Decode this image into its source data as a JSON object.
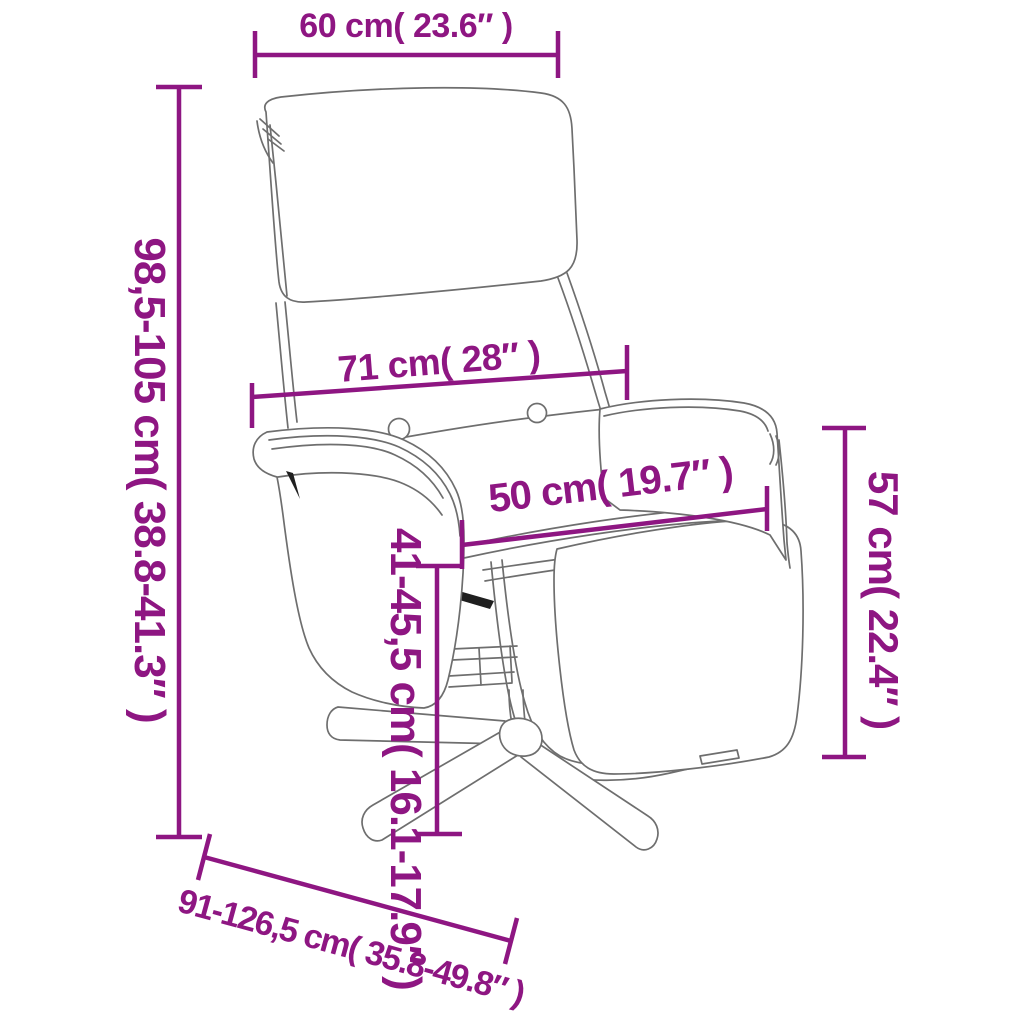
{
  "figure": {
    "type": "product-dimension-diagram",
    "subject": "recliner chair with footrest",
    "background_color": "#ffffff",
    "accent_color": "#8e1682",
    "line_art_color": "#6e6e6e"
  },
  "dimensions": {
    "headrest_width": {
      "label": "60 cm( 23.6″ )"
    },
    "overall_height": {
      "label": "98,5-105 cm( 38.8-41.3″ )"
    },
    "backrest_width": {
      "label": "71 cm( 28″ )"
    },
    "footrest_width": {
      "label": "50 cm( 19.7″ )"
    },
    "seat_height": {
      "label": "41-45,5 cm( 16.1-17.9″ )"
    },
    "side_height": {
      "label": "57 cm( 22.4″ )"
    },
    "overall_depth": {
      "label": "91-126,5 cm( 35.8-49.8″ )"
    }
  }
}
